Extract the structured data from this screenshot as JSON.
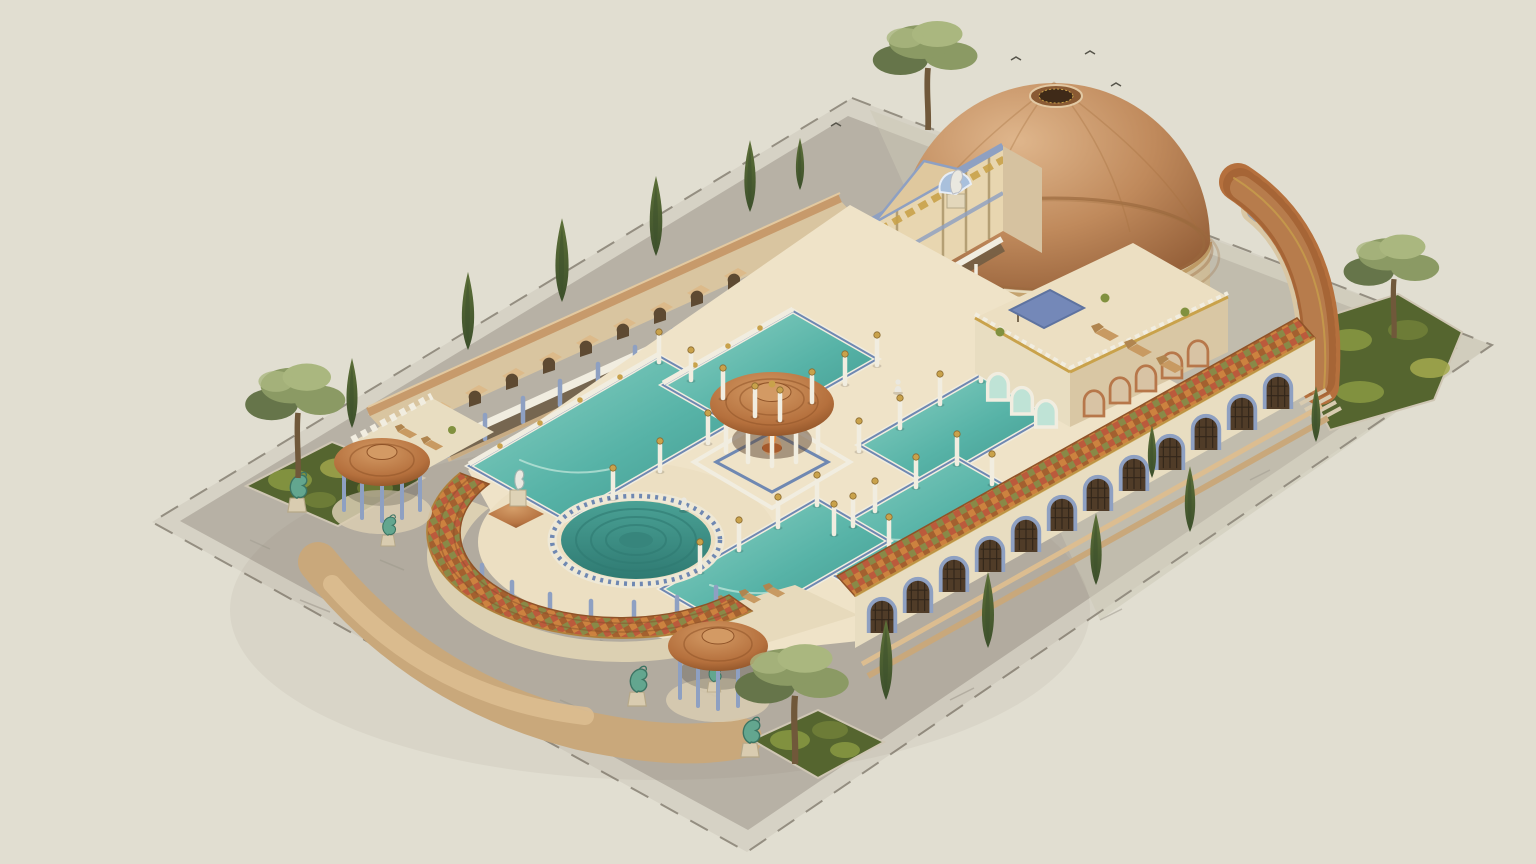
{
  "meta": {
    "alt": "Isometric architectural illustration of a Roman bath complex: a large brown-domed rotunda with oculus, a gilded entrance pavilion with a shell statue, colonnaded courtyards with turquoise bathing pools arranged around a central tholos pavilion with a brazier, a semicircular tiled exedra enclosing a round stepped pool, tiled gazebos, verdigris statues, cypress and pine trees, all on a pale cobbled plaza."
  },
  "palette": {
    "bg": "#e1ded1",
    "plazaBorder": "#d6d2c5",
    "plaza": "#b7b1a5",
    "plazaLine": "#948e81",
    "plazaLight": "#ccc7b6",
    "path": "#c9a87b",
    "pathLight": "#dcbd90",
    "wall": "#e8ddc1",
    "wallShade": "#d9c7a4",
    "wallDark": "#b9a37d",
    "cream": "#efe3c8",
    "white": "#f1ede0",
    "roof": "#b5703d",
    "roofLight": "#d39a64",
    "roofDark": "#8f5328",
    "roofSeam": "#8a4f2a",
    "dome": "#c08a5c",
    "domeLight": "#dfb68c",
    "domeDark": "#96613a",
    "domeRim": "#9a6a3e",
    "tileRed": "#bb5a3c",
    "tileOrange": "#cc823f",
    "tileGreen": "#7e8b49",
    "tileBrown": "#a3602f",
    "water": "#57b3a7",
    "waterLight": "#8ed3c5",
    "waterDeep": "#3e948b",
    "waterPale": "#bfe3d6",
    "blue": "#8ea0c2",
    "blueDark": "#5e73a0",
    "mosaic": "#6f88b2",
    "gold": "#c9a24b",
    "goldDark": "#8a6a30",
    "verdigris": "#63a68f",
    "verdigrisDark": "#3c7463",
    "shrub": "#55652f",
    "shrubLight": "#81913f",
    "shrubYellow": "#a5a94e",
    "cypress": "#3c4f2b",
    "cypressLight": "#5d7038",
    "pine": "#8b9a64",
    "pineLight": "#aab77f",
    "pineDark": "#66754a",
    "trunk": "#70583a",
    "flame": "#e8822f",
    "flameLight": "#f6c35a",
    "statue": "#eae8e0",
    "statueBlue": "#a9c0dc",
    "opening": "#503c28",
    "lattice": "#32261a",
    "recess": "#6b5a42"
  },
  "scene": {
    "structures": [
      {
        "id": "plaza",
        "label": "Cobbled plaza platform"
      },
      {
        "id": "rotunda",
        "label": "Domed rotunda hall with oculus"
      },
      {
        "id": "entrance-pavilion",
        "label": "Gilded entrance pavilion with shell statue"
      },
      {
        "id": "northwest-colonnade",
        "label": "Colonnade wall with stalls and torches"
      },
      {
        "id": "southeast-arcade",
        "label": "Arcade wall with lattice arches and checkered tile roof"
      },
      {
        "id": "corner-terrace",
        "label": "Corner terrace pavilion with awning and loungers"
      },
      {
        "id": "central-tholos",
        "label": "Central tholos pavilion with brazier"
      },
      {
        "id": "exedra",
        "label": "Semicircular exedra colonnade"
      },
      {
        "id": "round-pool",
        "label": "Round stepped mosaic pool"
      },
      {
        "id": "bathing-pools",
        "label": "Five rectangular turquoise pools"
      },
      {
        "id": "gazebos",
        "label": "Two tiled gazebos with verdigris statues"
      },
      {
        "id": "gardens",
        "label": "Three shrub garden beds with trees"
      }
    ],
    "pool_count": 6,
    "gazebo_count": 2,
    "garden_count": 3
  }
}
